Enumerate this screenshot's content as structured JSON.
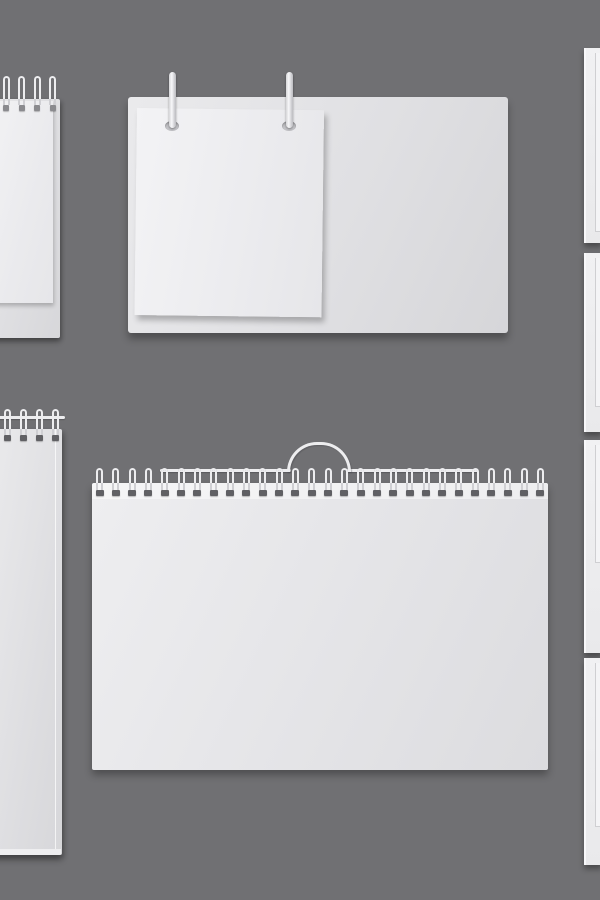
{
  "scene": {
    "title": "Blank spiral calendar and notepad mockups",
    "background_color": "#707073",
    "objects": [
      {
        "id": "notepad-top-left",
        "type": "spiral notepad with top page, cropped at left edge"
      },
      {
        "id": "desk-calendar-top",
        "type": "desk flip calendar board with two metal pins and blank page"
      },
      {
        "id": "side-panels",
        "type": "four cropped white boards stacked along right edge"
      },
      {
        "id": "notepad-bottom-left",
        "type": "tall spiral notepad with hanger wire, cropped at left edge"
      },
      {
        "id": "wall-calendar-bottom",
        "type": "wide wire-bound wall calendar with hanging wire handle"
      }
    ]
  },
  "colors": {
    "bg": "#707073",
    "wire": "#ededef",
    "wire_leg": "#cfcfd3",
    "cap_dark": "#606064",
    "cap_mid": "#8a8a8e",
    "board_light": "#ececee",
    "board_dark": "#d8d8db",
    "page_light": "#f4f4f6",
    "page_dark": "#e7e7ea",
    "panel_face": "#efeff1",
    "panel_edge": "#f8f8fa",
    "panel_line": "#cfcfd2"
  },
  "mockups": {
    "notepad_top_left": {
      "binding": {
        "count": 5,
        "start": -13,
        "spacing": 15.5,
        "top": 76,
        "loop_h": 23,
        "leg_h": 6,
        "cap_w": 6,
        "cap_h": 6,
        "cap_color": "cap_mid"
      }
    },
    "notepad_bottom_left": {
      "binding": {
        "count": 5,
        "start": -12,
        "spacing": 16,
        "top": 409,
        "loop_h": 20,
        "leg_h": 6,
        "cap_w": 7,
        "cap_h": 6,
        "cap_color": "cap_dark"
      }
    },
    "wall_calendar_bottom": {
      "binding": {
        "count": 28,
        "start": 96,
        "spacing": 16.33,
        "top": 468,
        "loop_h": 15,
        "leg_h": 7,
        "cap_w": 8,
        "cap_h": 6,
        "cap_color": "cap_dark"
      }
    }
  },
  "side_panels": [
    {
      "top": 48,
      "height": 195,
      "page_bottom": 184
    },
    {
      "top": 253,
      "height": 179,
      "page_bottom": 154
    },
    {
      "top": 440,
      "height": 213,
      "page_bottom": 123
    },
    {
      "top": 658,
      "height": 207,
      "page_bottom": 169
    }
  ]
}
